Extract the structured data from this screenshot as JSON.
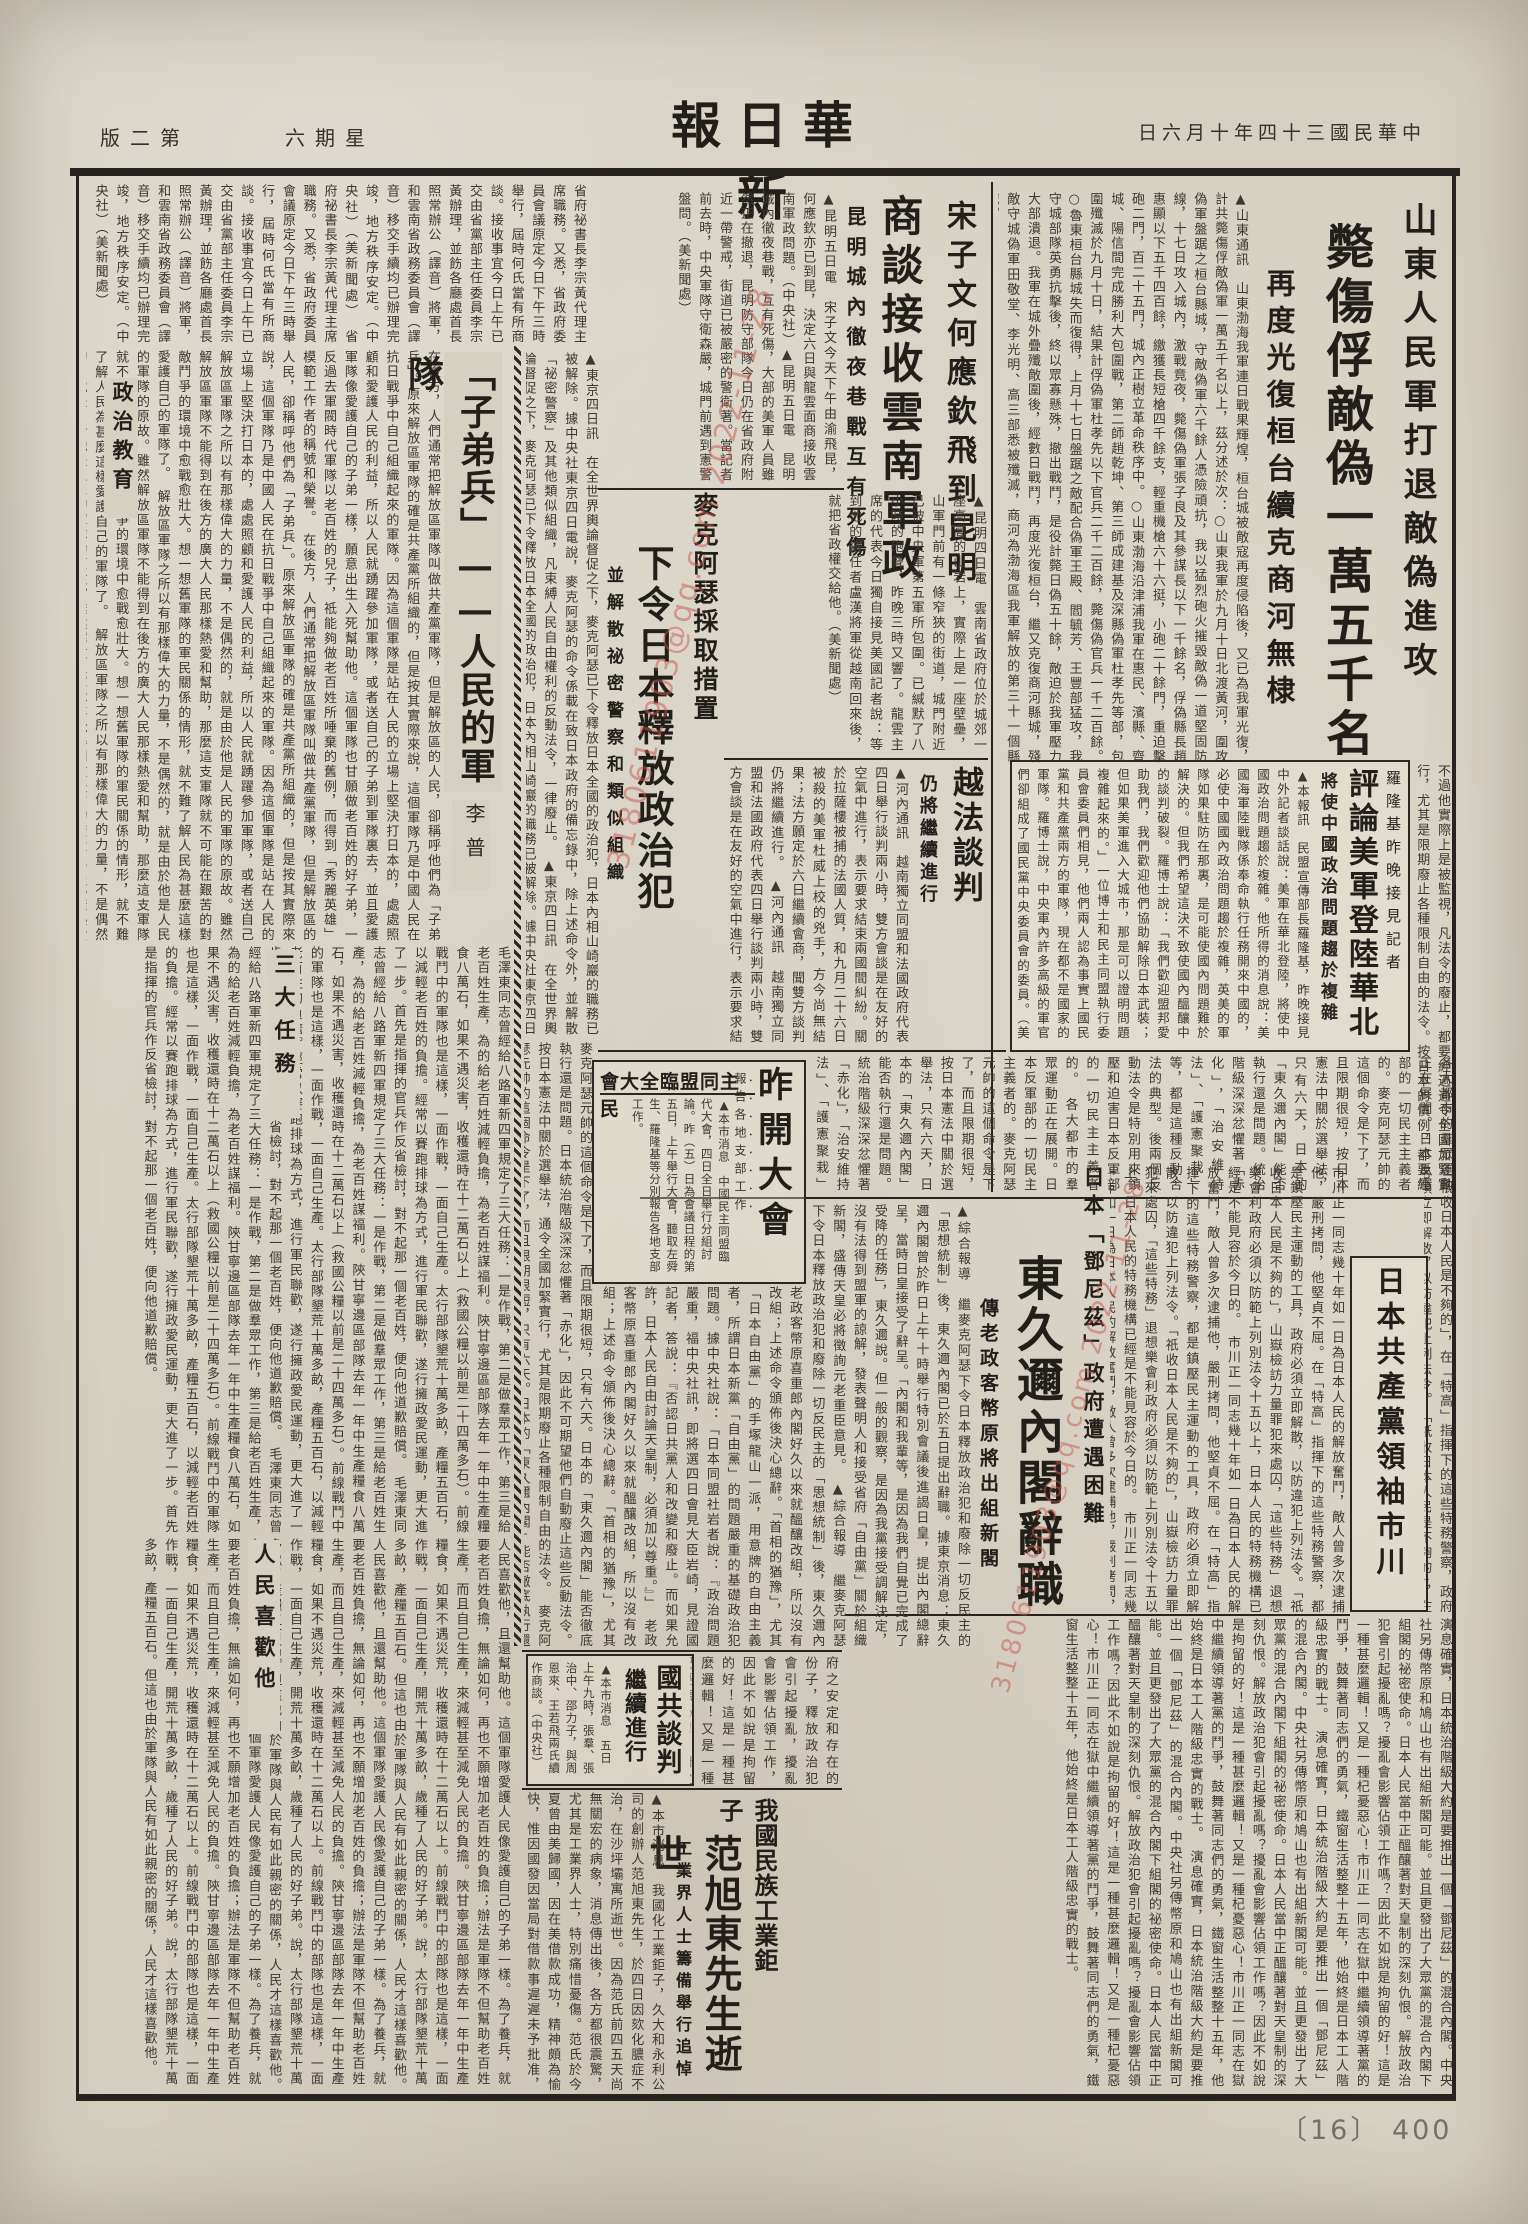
{
  "page": {
    "paper": "#d6d0c2",
    "ink": "#34302b",
    "frame": "#262320",
    "red": "#c8574a",
    "archive_number": "〔16〕 400"
  },
  "masthead": {
    "title_display": "報日華新",
    "date_display": "日六月十年四十三國民華中",
    "weekday_display": "六期星",
    "edition_display": "版二第"
  },
  "watermark": {
    "text": "3180611903@qq.com 2022-11-28"
  },
  "articles": {
    "shandong": {
      "col1": "山東人民軍打退敵偽進攻",
      "headline": "斃傷俘敵偽一萬五千名",
      "col3": "再度光復桓台續克商河無棣",
      "body": "▲山東通訊　山東渤海我軍連日戰果輝煌，桓台城被敵寇再度侵陷後，又已為我軍光復，計共斃傷俘敵偽軍一萬五千名以上，茲分述於次：○山東我軍於九月十日北渡黃河，圍攻偽軍盤踞之桓台縣城，守敵偽軍六千餘人憑險頑抗，我以猛烈砲火摧毀敵偽一道堅固防線，十七日攻入城內，激戰竟夜，斃傷偽軍張子良及其參謀長以下一千餘名，俘偽縣長趙惠顯以下五千四百餘，繳獲長短槍四千餘支，輕重機槍六十六挺，小砲二十餘門，重迫擊砲二門，百二十五門，城內正樹立革命秩序中。○山東渤海沿津浦我軍在惠民、濱縣、齊城、陽信間完成勝利大包圍戰，第二師趙乾坤、第三師成建基及深縣偽軍杜孝先等部，包圍殲滅於九月十日，結果計俘偽軍杜孝先以下官兵二千二百餘，斃傷偽官兵一千二百餘。○魯東桓台縣城失而復得，上月十七日盤踞之敵配合偽軍王殿、閻毓芳、王豐部猛攻，我守城部隊英勇抗擊後，終以眾寡懸殊，撤出戰鬥，是役計斃日偽五十餘，敵迫於我軍壓力大部潰退。我軍在城外疊殲敵圍後，經數日戰鬥，再度光復桓台，繼又克復商河縣城，殘敵守城偽軍田敬堂、李光明、高三部悉被殲滅，商河為渤海區我軍解放的第三十一個縣城。"
    },
    "kunming": {
      "kicker": "宋子文何應欽飛到昆明",
      "headline": "商談接收雲南軍政",
      "subhead": "昆明城內徹夜巷戰互有死傷",
      "body": "▲昆明五日電　宋子文今天下午由渝飛昆，何應欽亦已到昆，決定六日與龍雲面商接收雲南軍政問題。（中央社）▲昆明五日電　昆明城內徹夜巷戰，互有死傷，大部的美軍人員雖然正在撤退，昆明防守部隊今日仍在省政府附近一帶警戒，街道已被嚴密的警衛著。當記者前去時，中央軍隊守衛森嚴，城門前遇到憲警盤問。（美新聞處）",
      "body_cont": "▲昆明四日電　雲南省政府位於城郊一座高高的山岩上，實際上是一座壁壘，山軍門前有一條窄狹的街道，城門附近已被中央軍第五軍所包圍。已緘默了八小時的砲聲，昨晚三時又響了。龍雲主席的代表今日獨自接見美國記者說：等到他的繼任者盧漢將軍從越南回來後，就把省政權交給他。（美新聞處）",
      "body2": "省府祕書長李宗黃代理主席職務。又悉，省政府委員會議原定今日下午三時舉行，屆時何氏當有所商談。接收事宜今日上午已交由省黨部主任委員李宗黃辦理，並飭各廳處首長照常辦公（譯音）將軍，和雲南省政務委員會（譯音）移交手續均已辦理完竣，地方秩序安定。（中央社）（美新聞處）"
    },
    "macarthur": {
      "kicker": "麥克阿瑟採取措置",
      "headline": "下令日本釋放政治犯",
      "subhead": "並解散祕密警察和類似組織",
      "body": "▲東京四日訊　在全世界輿論督促之下，麥克阿瑟已下令釋放日本全國的政治犯，日本內相山崎巖的職務已被解除。據中央社東京四日電說，麥克阿瑟的命令係載在致日本政府的備忘錄中，除上述命令外，並解散「祕密警察」及其他類似組織，凡束縛人民自由權利的反動法令，一律廢止。",
      "body2": "麥克阿瑟元帥的這個命令是下了，而且限期很短，只有六天。日本的「東久邇內閣」能否徹底執行還是問題。日本統治階級深深忿懼著「赤化」，因此不可期望他們自動廢止這些反動法令。按日本憲法中關於選舉法，通令全國加緊實行，尤其是限期廢止各種限制自由的法令。"
    },
    "yuefa": {
      "headline": "越法談判",
      "subhead": "仍將繼續進行",
      "body": "▲河內通訊　越南獨立同盟和法國政府代表四日舉行談判兩小時，雙方會談是在友好的空氣中進行，表示要求結束兩國間糾紛。關於拉薩樓被捕的法國人質，和九月二十六日被殺的美軍杜威上校的兇手，方今尚無結果；法方願定於六日繼續會商，聞雙方談判仍將繼續進行。"
    },
    "luolongji": {
      "kicker": "羅隆基昨晚接見記者",
      "headline": "評論美軍登陸華北",
      "subhead": "將使中國政治問題趨於複雜",
      "body": "▲本報訊　民盟宣傳部長羅隆基，昨晚接見中外記者談話說：美軍在華北登陸，將使中國政治問題趨於複雜。他所得的消息說：美國海軍陸戰隊係奉命執行任務開來中國的，必使中國國內政治問題趨於複雜，英美的軍隊如果駐防在那裏，是可能使國內問題難於解決的。但我們希望這決不致使國內醞釀中的談判破裂。羅博士說：「我們歡迎盟邦愛助我們，我們歡迎他們協助解除日本武裝；但如果美軍進入大城市，那是可以證明問題複雜起來的。」一位博士和民主同盟執行委員會委員們相見，他們兩人認為事實上國民黨和共產黨兩方的軍隊，現在都不是國家的軍隊。羅博士說，中央軍內許多高級的軍官們卻組成了國民黨中央委員會的委員。（美新聞處）"
    },
    "mengmeng": {
      "over_headline": "會大全臨盟同主民",
      "headline": "昨開大會",
      "kicker": "報告各地支部工作",
      "body": "▲本市消息　中國民主同盟臨代大會，四日全日舉行分組討論。昨（五）日為會議日程的第五日，上午舉行大會，聽取左舜生、羅隆基等分別報告各地支部工作。"
    },
    "dongjiuer": {
      "kicker": "日本「鄧尼茲」政府遭遇困難",
      "headline": "東久邇內閣辭職",
      "subhead": "傳老政客幣原將出組新閣",
      "body": "▲綜合報導　繼麥克阿瑟下令日本釋放政治犯和廢除一切反民主的「思想統制」後，東久邇內閣已於五日提出辭職。據東京消息：東久邇內閣曾於昨日上午十時舉行特別會議後進謁日皇，提出內閣總辭呈，當時日皇接受了辭呈。「內閣和我輩等，是因為我們自覺已完成了受降的任務」，東久邇說。但一般的觀察，是因為我黨接受調解決定，沒有法得到盟軍的諒解，發表聲明人和接受省府「自由黨」關於組織新閣，盛傳天皇必將徵詢元老重臣意見。",
      "body2": "老政客幣原喜重郎內閣好久以來就醞釀改組，所以沒有改組；上述命令頒佈後決心總辭。「首相的猶豫」，尤其「日本自由黨」的手塚龍山一派，用意牌的自由主義者，所謂日本新黨「自由黨」的問題嚴重的基礎政治犯問題。據中央社說：「日本同盟社岩者說：『政治問題嚴重，福中央社訊，即將選四日會見大臣岩崎，見證國記者，答說：『否認日共黨人和改變和廢止。而如果允許，日本人民自由討論天皇制，必須加以尊重。』」"
    },
    "ichikawa": {
      "headline": "日本共產黨領袖市川",
      "body": "市川正一同志是知識份子出身，受了俄國十月革命和日本「米騷動」的影響而投入革命運動。一九二二年，他創辦了日本最初的革命文藝雜誌——「無產階級」，接著日本共產黨成立，他毅然獻身於黨的事業。一九二九年四月，日本全國大檢舉，他不幸被捕，在獄中他巧妙的進行了堅毅的鬥爭。"
    },
    "guogong": {
      "headline": "國共談判",
      "headline2": "繼續進行",
      "body": "▲本市消息　五日上午九時，張羣、張治中、邵力子，與周恩來、王若飛兩氏續作商談。（中央社）"
    },
    "fanxudong": {
      "kicker": "我國民族工業鉅子",
      "headline": "范旭東先生逝世",
      "subhead": "工業界人士籌備舉行追悼",
      "body": "▲本市消息　我國化工業鉅子，久大和永利公司的創辦人范旭東先生，於四日因欬化膿症不治，在沙坪壩寓所逝世。因為范氏前四五天尚無關宏的病象，消息傳出後，各方都很震驚，尤其是工業界人士，特別痛惜憂傷。范氏於今夏曾由美歸國，因在美借款成功，精神頗為愉快，惟因國發因當局對借款事遲遲未予批准，致這鬱鬱不樂。西南實業協會現正發起聯合其他各工業團體，籌備舉行追悼大會。（H）"
    },
    "essay": {
      "title": "「子弟兵」——人民的軍隊",
      "byline": "李普",
      "sub1": "政治教育",
      "sub2": "三大任務",
      "sub3": "人民喜歡他",
      "body1": "在後方，人們通常把解放區軍隊叫做共產黨軍隊，但是解放區的人民，卻稱呼他們為「子弟兵」。原來解放區軍隊的確是共產黨所組織的，但是按其實際來說，這個軍隊乃是中國人民在抗日戰爭中自己組織起來的軍隊。因為這個軍隊是站在人民的立場上堅決打日本的，處處照顧和愛護人民的利益，所以人民就踴躍參加軍隊，或者送自己的子弟到軍隊裏去，並且愛護軍隊像愛護自己的子弟一樣，願意出生入死幫助他。這個軍隊也甘願做老百姓的好子弟，一反過去軍閥時代軍隊以老百姓的兒子，祗能夠做老百姓所唾棄的舊例，而得到「秀麗英雄」模範工作者的稱號和榮譽。",
      "body2": "解放區軍隊之所以有那樣偉大的力量，不是偶然的，就是由於他是人民的軍隊的原故。雖然解放區軍隊不能得到在後方的廣大人民那樣熱愛和幫助，那麼這支軍隊就不可能在艱苦的對敵鬥爭的環境中愈戰愈壯大。想一想舊軍隊的軍民關係的情形，就不難了解人民為甚麼這樣愛護自己的軍隊了。",
      "body3": "毛澤東同志曾經給八路軍新四軍規定了三大任務：一是作戰，第二是做羣眾工作，第三是給老百姓生產，為的給老百姓減輕負擔，為老百姓謀福利。陝甘寧邊區部隊去年一年中生產糧食八萬石，如果不遇災害，收穫還時在十二萬石以上（救國公糧以前是二十四萬多石）。前線戰鬥中的軍隊也是這樣，一面作戰，一面自己生產。太行部隊墾荒十萬多畝，產糧五百石，以減輕老百姓的負擔。經常以賽跑排球為方式，進行軍民聯歡，遂行擁政愛民運動，更大進了一步。首先是指揮的官兵作反省檢討，對不起那一個老百姓，便向他道歉賠償。",
      "body4": "人民喜歡他，且還幫助他。這個軍隊愛護人民像愛護自己的子弟一樣。為了養兵，就要老百姓負擔，無論如何，再也不願增加老百姓的負擔；辦法是軍隊不但幫助老百姓生產，而且自己生產，來減輕甚至減免人民的負擔。陝甘寧邊區部隊去年一年中生產糧食，如果不遇災荒，收穫還時在十二萬石以上。前線戰鬥中的部隊也是這樣，一面作戰，一面自己生產，開荒十萬多畝，歲種了人民的好子弟。說，太行部隊墾荒十萬多畝，產糧五百石。但這也由於軍隊與人民有如此親密的關係，人民才這樣喜歡他。"
    }
  },
  "fill": {
    "band1": "各大都市的羣眾運動正在展開。日本反軍部的一切民主主義者的。麥克阿瑟元帥的這個命令是下了，而且限期很短，按日本憲法中關於選舉法，只有六天，日本的「東久邇內閣」能否執行還是問題。統治階級深深忿懼著「赤化」，「治安維持法」、「護憲聚栽」等，都是這種反動合法的典型。後兩個反動法令是特別用來鎮壓和迫害日本反軍部的一切民主主義者的。",
    "right_mid": "市川正一同志幾十年如一日為日本人民的解放奮鬥，敵人曾多次逮捕他，嚴刑拷問，他堅貞不屈。在「特高」指揮下的這些特務警察，都是鎮壓民主運動的工具，政府必須立即解散，以防違犯上列法令。「祇收日本人民是不夠的」，山嶽檢訪力量罪犯來處囚，「這些特務」退想樂會利政府必須以防範上列別法令十五以上，日本人民的特務機構已經是不能見容於今日的。",
    "right_edge": "「祇收日本人民是不夠的」，在「特高」指揮下的這些特務警察，政府必須立即解散，以防違犯上列法令。",
    "right_edge2": "不過他實際上是被監視，凡法令的廢止，都要經過通令全國加緊實行，尤其是限期廢止各種限制自由的法令。按日本的慣例，都要經過樞密院。",
    "bottom": "演息確實，日本統治階級大約是要推出一個「鄧尼茲」的混合內閣。中央社另傳幣原和鳩山也有出組新閣可能。並且更發出了大眾黨的混合內閣下組閣的祕密使命。日本人民當中正醞釀著對天皇制的深刻仇恨。解放政治犯會引起擾亂嗎？擾亂會影響佔領工作嗎？因此不如說是拘留的好！這是一種甚麼邏輯！又是一種杞憂惡心！市川正一同志在獄中繼續領導著黨的鬥爭，鼓舞著同志們的勇氣，鐵窗生活整整十五年，他始終是日本工人階級忠實的戰士。",
    "center_mid": "府之安定和存在的份子，釋放政治犯會引起擾亂，擾亂會影響佔領工作，因此不如說是拘留的好！這是一種甚麼邏輯！又是一種杞憂惡心！"
  }
}
